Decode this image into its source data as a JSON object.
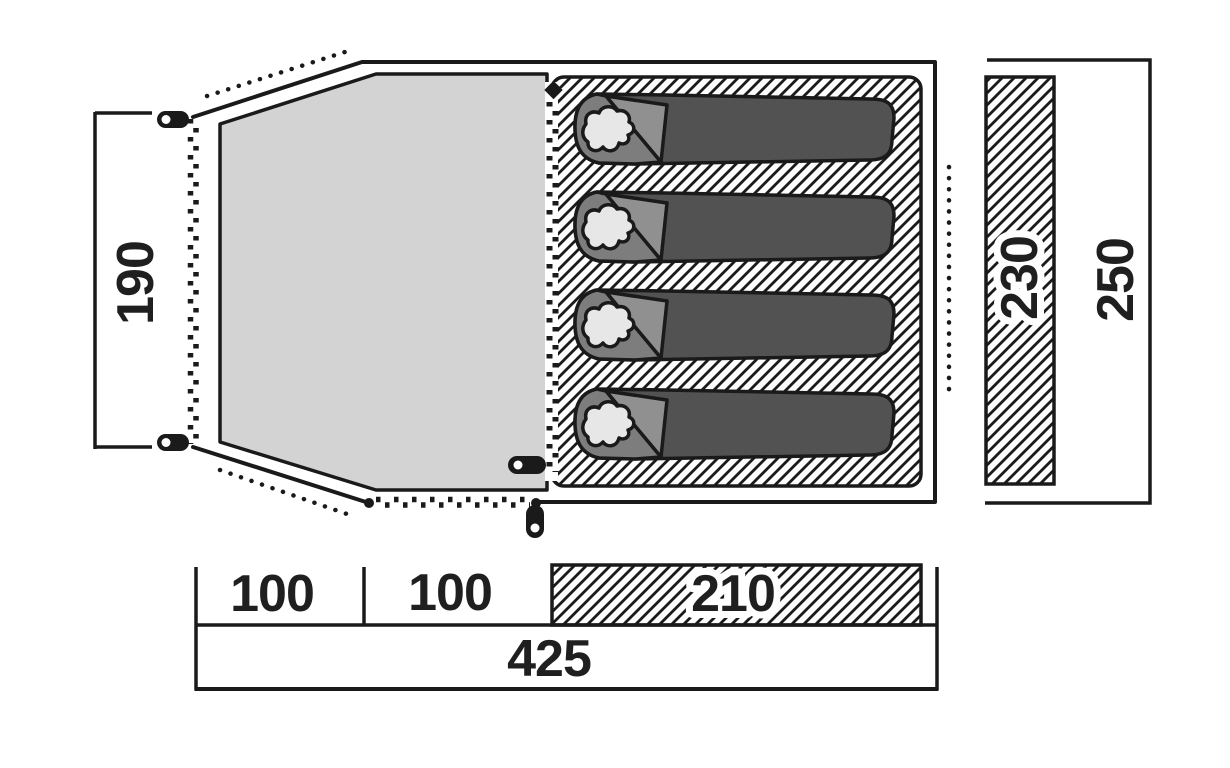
{
  "diagram": {
    "title": "tent-floorplan-top-view",
    "labels": {
      "porch_width": "190",
      "inner_width": "230",
      "outer_width": "250",
      "porch_section_1": "100",
      "porch_section_2": "100",
      "inner_length": "210",
      "total_length": "425"
    },
    "features": {
      "sleeping_bag_count": 4,
      "tent_pegs": 4,
      "zipper_door_lines": 3,
      "guy_line_dotted_lines": 3,
      "hatched_regions": [
        "inner-sleeping-area",
        "inner-width-bar-230",
        "inner-length-cell-210"
      ]
    },
    "colors": {
      "line": "#1a1a1a",
      "groundsheet_gray": "#d2d3d2",
      "bag_body": "#525252",
      "bag_hood": "#7d7d7d",
      "bag_flap": "#909090",
      "pillow": "#e7e7e7",
      "background": "#ffffff"
    }
  }
}
